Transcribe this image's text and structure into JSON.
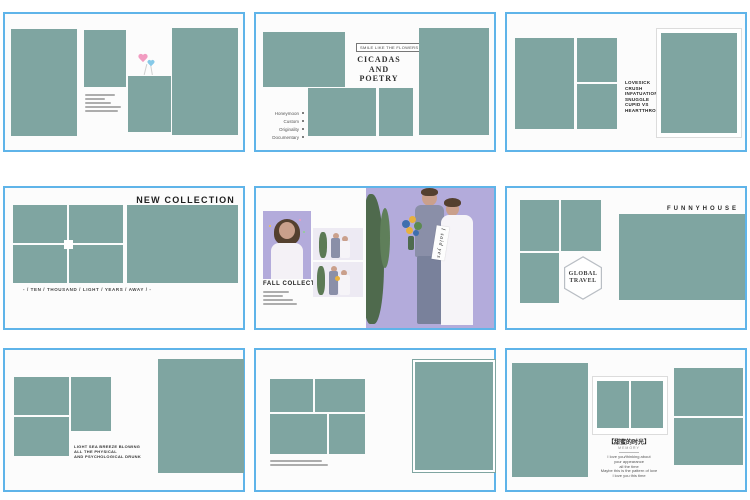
{
  "palette": {
    "tile_border": "#5fb4e9",
    "placeholder_teal": "#7fa5a1",
    "photo_lavender": "#b3abdb",
    "heart_pink": "#f29cc1",
    "heart_blue": "#86c9e8"
  },
  "tiles": {
    "t2": {
      "badge": "SMILE LIKE THE FLOWERS",
      "title1": "CICADAS",
      "title2": "AND",
      "title3": "POETRY",
      "menu": [
        "Honeymoon",
        "Custom",
        "Originality",
        "Documentary"
      ]
    },
    "t3": {
      "words": [
        "LOVESICK",
        "CRUSH",
        "INFATUATION",
        "SNUGGLE",
        "CUPID VS",
        "HEARTTHROB"
      ]
    },
    "t4": {
      "header": "NEW COLLECTION",
      "caption": "- / TEN / THOUSAND / LIGHT / YEARS / AWAY / -"
    },
    "t5": {
      "title": "FALL COLLECTION",
      "banner": "I said yes"
    },
    "t6": {
      "header": "FUNNYHOUSE",
      "hex1": "GLOBAL",
      "hex2": "TRAVEL"
    },
    "t7": {
      "cap1": "LIGHT SEA BREEZE BLOWING",
      "cap2": "ALL THE PHYSICAL",
      "cap3": "AND PSYCHOLOGICAL DRUNK"
    },
    "t9": {
      "title": "【甜蜜的时光】",
      "subtitle": "MEMORY",
      "poem": [
        "I love you/thinking about",
        "your appearance",
        "all the time",
        "Maybe this is the pattern of love",
        "I love you this time"
      ]
    }
  }
}
